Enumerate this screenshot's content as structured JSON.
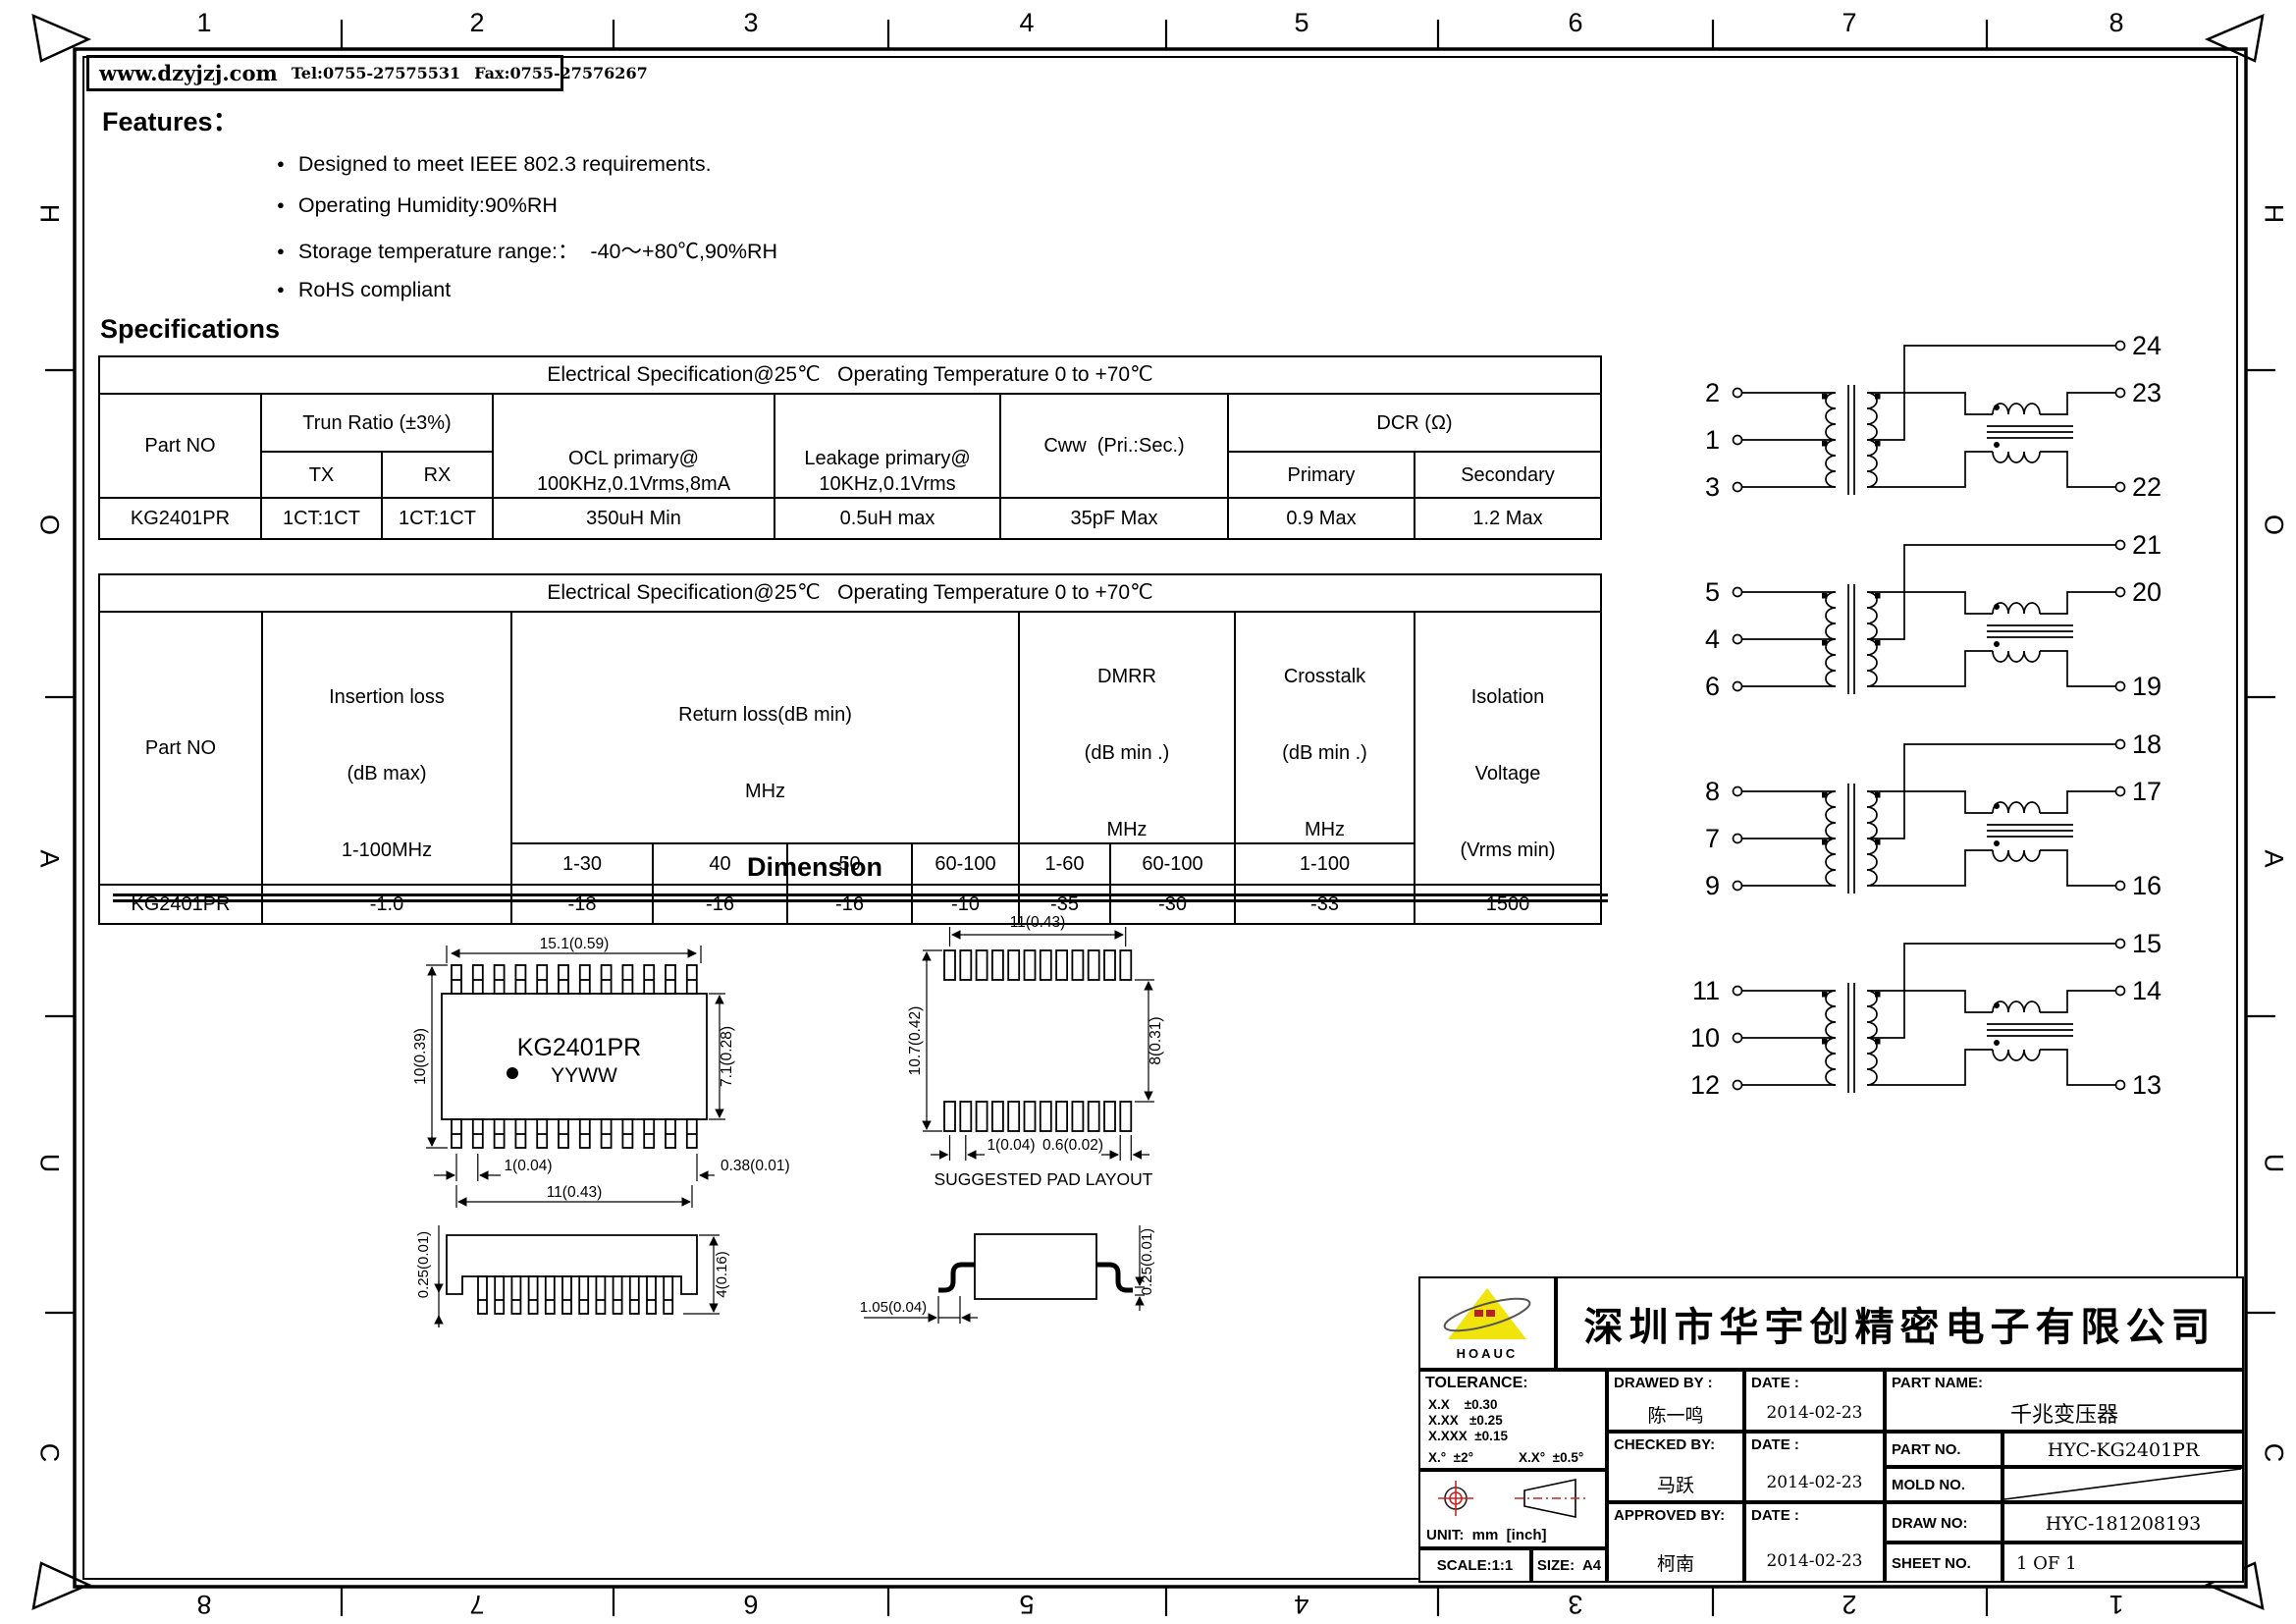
{
  "border": {
    "top_numbers": [
      "1",
      "2",
      "3",
      "4",
      "5",
      "6",
      "7",
      "8"
    ],
    "bottom_numbers": [
      "8",
      "7",
      "6",
      "5",
      "4",
      "3",
      "2",
      "1"
    ],
    "side_letters": [
      "H",
      "O",
      "A",
      "U",
      "C"
    ]
  },
  "header": {
    "website": "www.dzyjzj.com",
    "tel": "Tel:0755-27575531",
    "fax": "Fax:0755-27576267"
  },
  "features": {
    "title": "Features：",
    "items": [
      "Designed to meet IEEE 802.3 requirements.",
      "Operating Humidity:90%RH",
      "Storage temperature range:：  -40～+80℃,90%RH",
      "RoHS compliant"
    ]
  },
  "specifications": {
    "title": "Specifications",
    "table1": {
      "title": "Electrical Specification@25℃   Operating Temperature 0 to +70℃",
      "col_part": "Part NO",
      "col_trun": "Trun Ratio (±3%)",
      "col_tx": "TX",
      "col_rx": "RX",
      "col_ocl": {
        "l1": "OCL primary@",
        "l2": "100KHz,0.1Vrms,8mA"
      },
      "col_leakage": {
        "l1": "Leakage primary@",
        "l2": "10KHz,0.1Vrms"
      },
      "col_cww": "Cww  (Pri.:Sec.)",
      "col_dcr": "DCR (Ω)",
      "col_primary": "Primary",
      "col_secondary": "Secondary",
      "row": {
        "part_no": "KG2401PR",
        "tx": "1CT:1CT",
        "rx": "1CT:1CT",
        "ocl": "350uH Min",
        "leakage": "0.5uH max",
        "cww": "35pF Max",
        "dcr_primary": "0.9 Max",
        "dcr_secondary": "1.2 Max"
      }
    },
    "table2": {
      "title": "Electrical Specification@25℃   Operating Temperature 0 to +70℃",
      "col_part": "Part NO",
      "col_insertion": {
        "l1": "Insertion loss",
        "l2": "(dB max)",
        "l3": "1-100MHz"
      },
      "col_return": {
        "l1": "Return loss(dB min)",
        "l2": "MHz"
      },
      "col_dmrr": {
        "l1": "DMRR",
        "l2": "(dB min .)",
        "l3": "MHz"
      },
      "col_crosstalk": {
        "l1": "Crosstalk",
        "l2": "(dB min .)",
        "l3": "MHz"
      },
      "col_isolation": {
        "l1": "Isolation",
        "l2": "Voltage",
        "l3": "(Vrms min)"
      },
      "sub": {
        "rl1": "1-30",
        "rl2": "40",
        "rl3": "50",
        "rl4": "60-100",
        "dm1": "1-60",
        "dm2": "60-100",
        "xt": "1-100"
      },
      "row": {
        "part_no": "KG2401PR",
        "insertion": "-1.0",
        "rl1": "-18",
        "rl2": "-16",
        "rl3": "-16",
        "rl4": "-10",
        "dm1": "-35",
        "dm2": "-30",
        "xt": "-33",
        "isolation": "1500"
      }
    }
  },
  "dimension": {
    "title": "Dimension",
    "top_view": {
      "part": "KG2401PR",
      "date_code": "YYWW",
      "width": "15.1(0.59)",
      "height": "10(0.39)",
      "body_height": "7.1(0.28)",
      "pitch": "1(0.04)",
      "span": "11(0.43)",
      "pin_width": "0.38(0.01)"
    },
    "pad_layout": {
      "caption": "SUGGESTED PAD LAYOUT",
      "width": "11(0.43)",
      "height": "10.7(0.42)",
      "inner_height": "8(0.31)",
      "pitch": "1(0.04)",
      "pad_width": "0.6(0.02)"
    },
    "front_view": {
      "standoff": "0.25(0.01)",
      "height": "4(0.16)"
    },
    "side_view": {
      "foot_length": "1.05(0.04)",
      "standoff": "0.25(0.01)"
    }
  },
  "schematic": {
    "circuits": [
      {
        "left": [
          "2",
          "1",
          "3"
        ],
        "right": [
          "24",
          "23",
          "22"
        ]
      },
      {
        "left": [
          "5",
          "4",
          "6"
        ],
        "right": [
          "21",
          "20",
          "19"
        ]
      },
      {
        "left": [
          "8",
          "7",
          "9"
        ],
        "right": [
          "18",
          "17",
          "16"
        ]
      },
      {
        "left": [
          "11",
          "10",
          "12"
        ],
        "right": [
          "15",
          "14",
          "13"
        ]
      }
    ]
  },
  "title_block": {
    "logo_text": "HOAUC",
    "company": "深圳市华宇创精密电子有限公司",
    "tolerance": {
      "label": "TOLERANCE:",
      "r1": "X.X    ±0.30",
      "r2": "X.XX   ±0.25",
      "r3": "X.XXX  ±0.15",
      "r4": "X.°  ±2°",
      "r5": "X.X°  ±0.5°"
    },
    "unit": "UNIT:  mm  [inch]",
    "scale": "SCALE:1:1",
    "size": "SIZE:  A4",
    "drawed_by": {
      "label": "DRAWED BY :",
      "name": "陈一鸣"
    },
    "checked_by": {
      "label": "CHECKED BY:",
      "name": "马跃"
    },
    "approved_by": {
      "label": "APPROVED BY:",
      "name": "柯南"
    },
    "date_label": "DATE :",
    "date1": "2014-02-23",
    "date2": "2014-02-23",
    "date3": "2014-02-23",
    "part_name": {
      "label": "PART NAME:",
      "value": "千兆变压器"
    },
    "part_no": {
      "label": "PART NO.",
      "value": "HYC-KG2401PR"
    },
    "mold_no": {
      "label": "MOLD NO.",
      "value": ""
    },
    "draw_no": {
      "label": "DRAW NO:",
      "value": "HYC-181208193"
    },
    "sheet_no": {
      "label": "SHEET NO.",
      "value": "1 OF 1"
    }
  }
}
